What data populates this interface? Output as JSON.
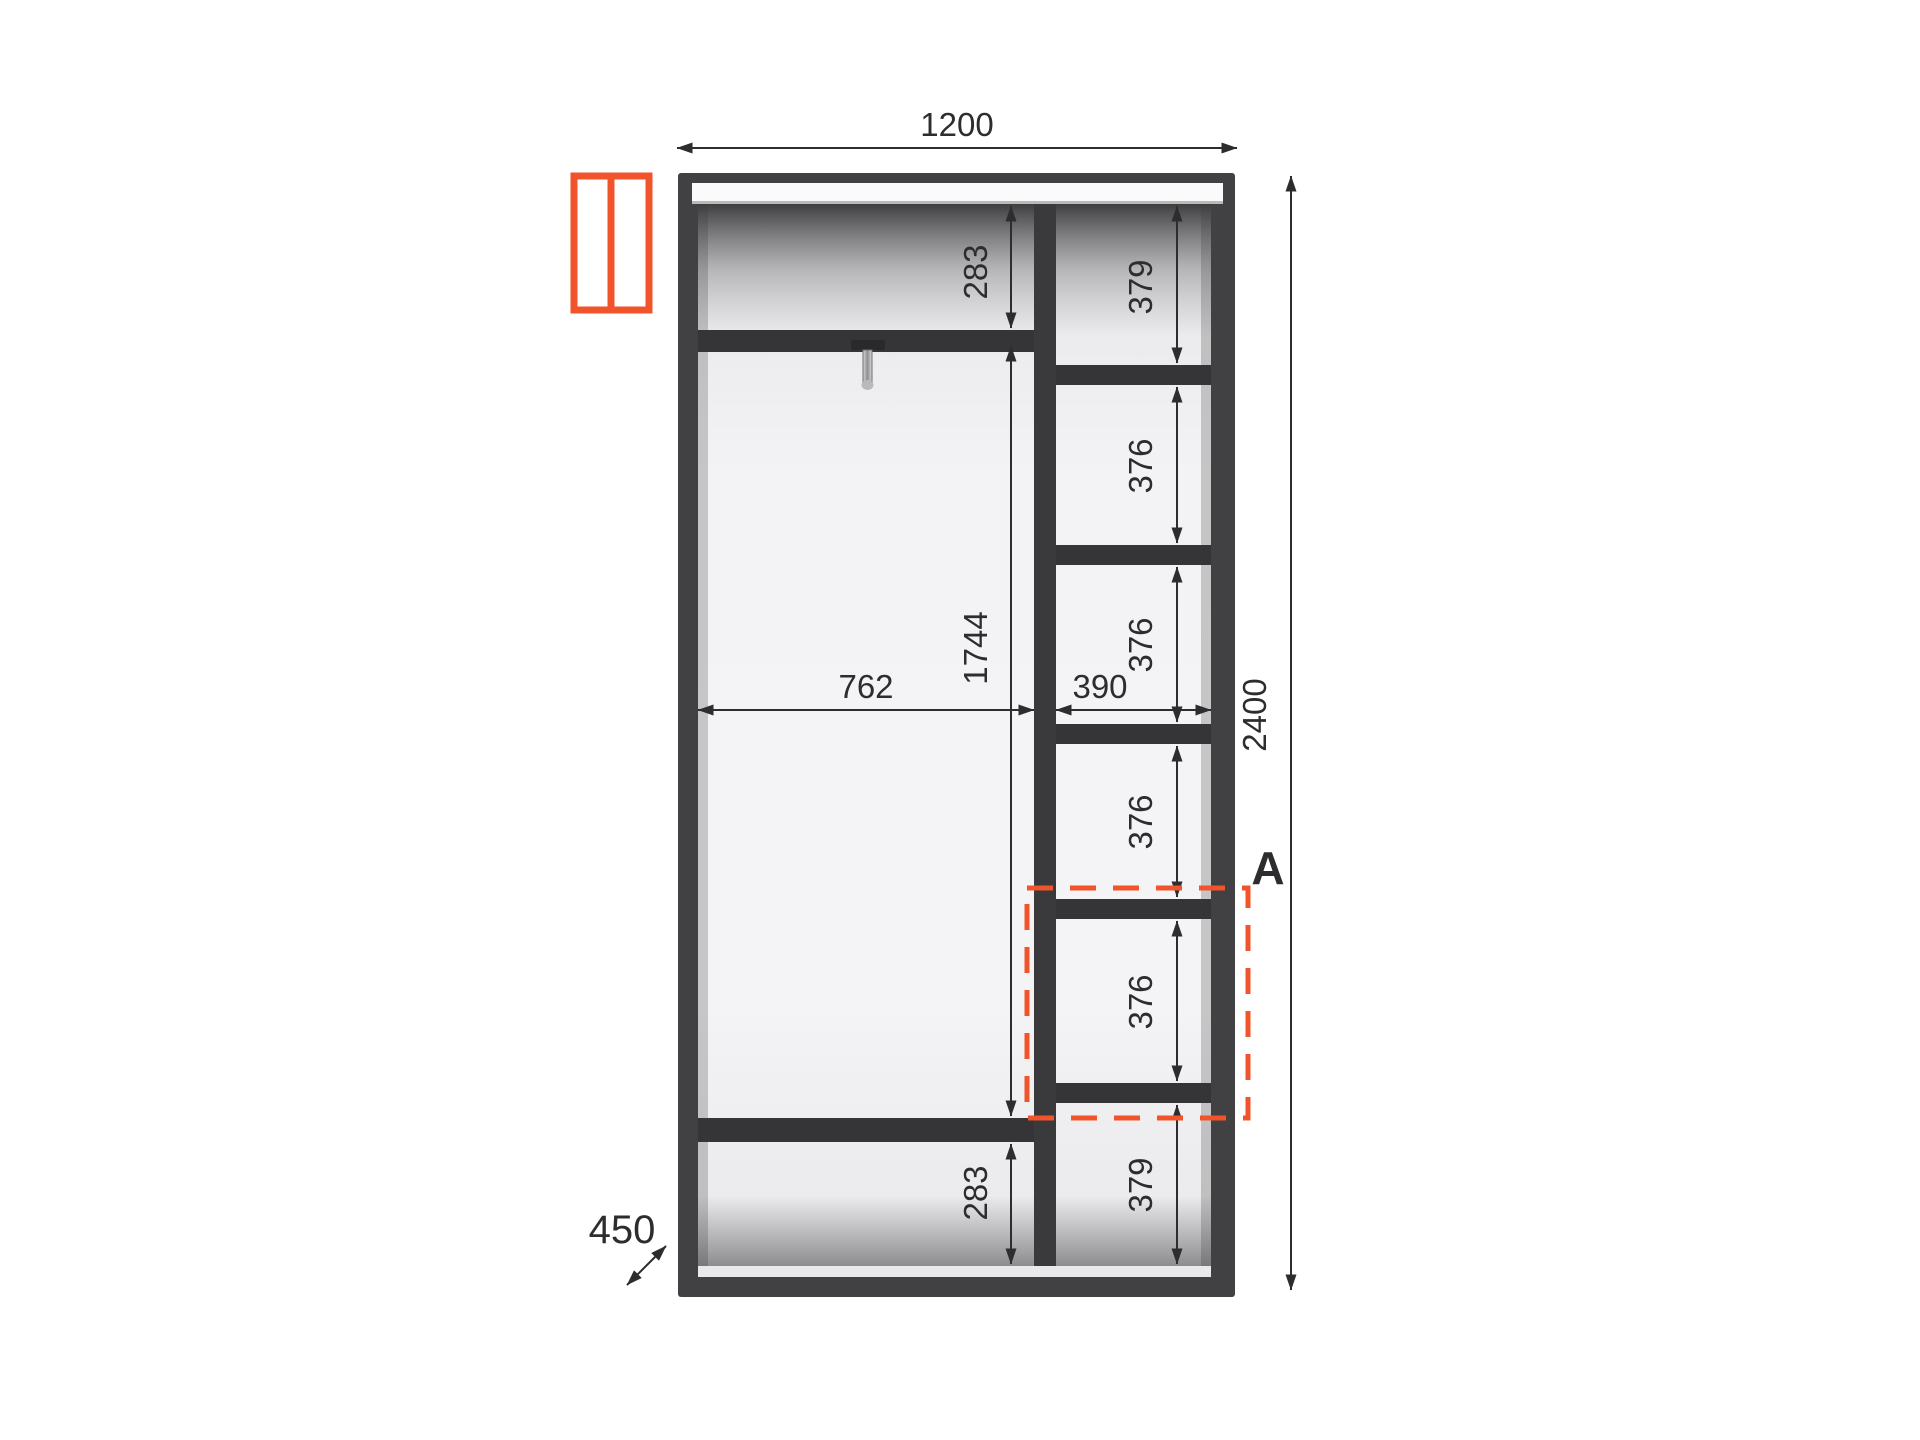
{
  "colors": {
    "accent": "#F1542A",
    "frame": "#414144",
    "shelf": "#353537",
    "dimension": "#2D2D2F",
    "interior": "#F2F2F4"
  },
  "icons": {
    "legend": "two-door-wardrobe-icon"
  },
  "wardrobe": {
    "overall_width_mm": "1200",
    "overall_height_mm": "2400",
    "depth_mm": "450",
    "left_section": {
      "clear_width_mm": "762",
      "top_shelf_offset_mm": "283",
      "hanging_space_mm": "1744",
      "bottom_space_mm": "283"
    },
    "right_section": {
      "clear_width_mm": "390",
      "compartment_heights_mm": [
        "379",
        "376",
        "376",
        "376",
        "376",
        "379"
      ]
    },
    "detail_callout_label": "A"
  }
}
